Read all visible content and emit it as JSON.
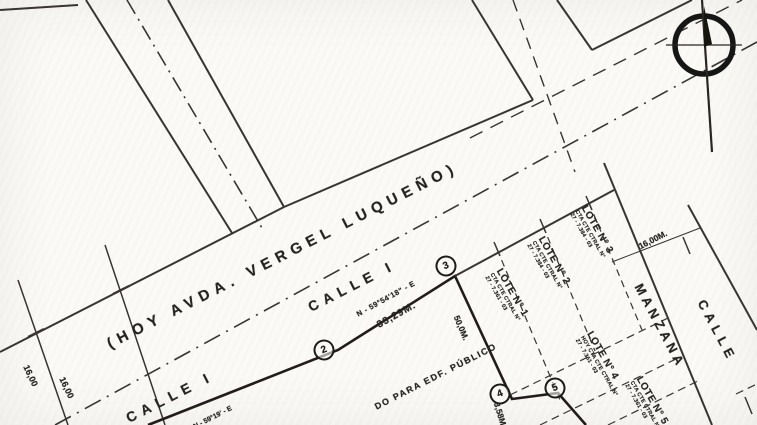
{
  "colors": {
    "ink": "#2a2722",
    "paper": "#fbfaf7"
  },
  "icons": {
    "compass": "north-compass-rose"
  },
  "streets": {
    "former_name": "(HOY AVDA. VERGEL LUQUEÑO)",
    "calle_i_upper": "CALLE I",
    "calle_i_lower": "CALLE I",
    "cross_street": "CALLE",
    "block_label": "MANZANA"
  },
  "annotations": {
    "bearing_main": "N - 59°54'18\" - E",
    "bearing_secondary": "N - 59°19' - E",
    "length_main": "33,29M.",
    "width_left_a": "16,00",
    "width_left_b": "16,00",
    "width_right": "16,00M.",
    "lot_depth": "50,0M.",
    "short_side": "3,58M.",
    "public_parcel": "DO PARA EDF. PÚBLICO"
  },
  "vertices": [
    {
      "label": "2"
    },
    {
      "label": "3"
    },
    {
      "label": "4"
    },
    {
      "label": "5"
    }
  ],
  "lots": [
    {
      "name": "LOTE N° 1",
      "account": "CTA CTE CTRAL N°",
      "number": "27 - 7.361 - 03"
    },
    {
      "name": "LOTE N° 2",
      "account": "CTA CTE CTRAL N°",
      "number": "27 - 7.384 - 03"
    },
    {
      "name": "LOTE N° 3",
      "account": "CTA CTE CTRAL N°",
      "number": "27 - 7.384 - 03"
    },
    {
      "name": "LOTE N° 4",
      "account": "HOY CTA CTE CTRAL N°",
      "number": "27 - 7.361 - 03"
    },
    {
      "name": "LOTE N° 5",
      "account": "CTA CTE CTRAL N°",
      "number": "27 - 7.361 - 03"
    }
  ]
}
